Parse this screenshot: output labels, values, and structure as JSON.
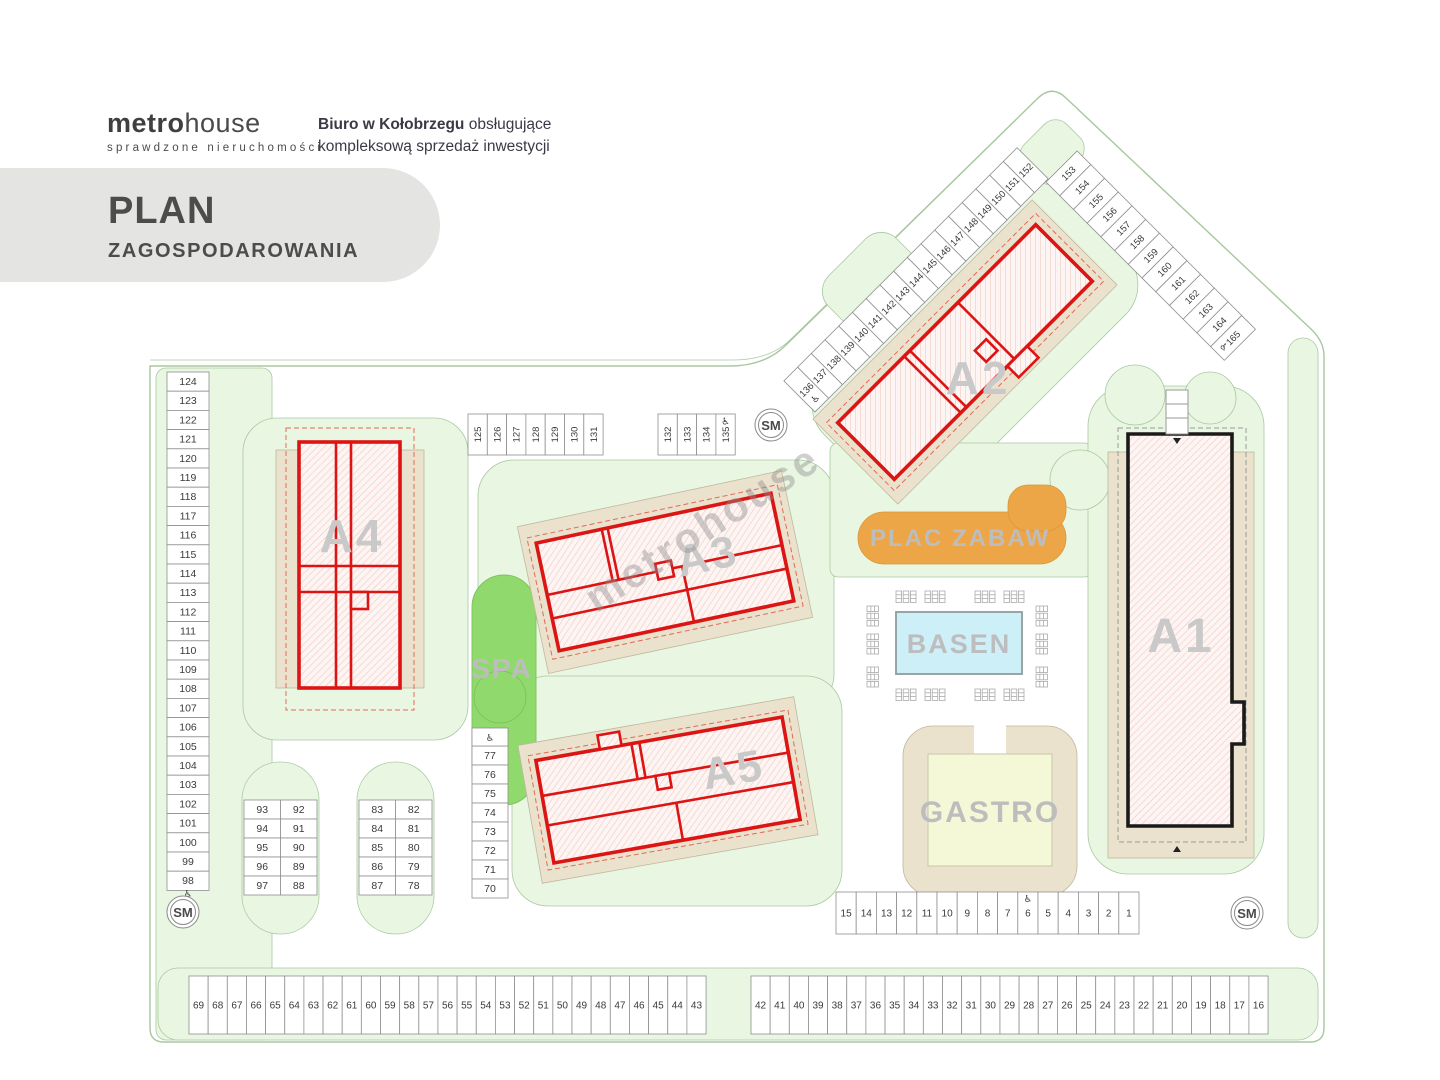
{
  "header": {
    "logo_primary": "metro",
    "logo_secondary": "house",
    "logo_tagline": "sprawdzone nieruchomości",
    "office_line1_bold": "Biuro w Kołobrzegu",
    "office_line1_rest": " obsługujące",
    "office_line2": "kompleksową sprzedaż inwestycji",
    "title_line1": "PLAN",
    "title_line2": "ZAGOSPODAROWANIA"
  },
  "watermark": "metrohouse",
  "icons": {
    "disabled": "♿"
  },
  "map": {
    "buildings": {
      "a1": "A1",
      "a2": "A2",
      "a3": "A3",
      "a4": "A4",
      "a5": "A5"
    },
    "areas": {
      "spa": "SPA",
      "basen": "BASEN",
      "gastro": "GASTRO",
      "plac_zabaw": "PLAC ZABAW"
    },
    "sm_label": "SM",
    "colors": {
      "building_outline": "#dd1414",
      "a1_outline": "#1a1a1a",
      "greenery": "#e9f6e2",
      "spa_green": "#90da6d",
      "playground_orange": "#eca648",
      "pool_blue": "#cdeff8"
    }
  },
  "parking": {
    "left_column": {
      "numbers": [
        "124",
        "123",
        "122",
        "121",
        "120",
        "119",
        "118",
        "117",
        "116",
        "115",
        "114",
        "113",
        "112",
        "111",
        "110",
        "109",
        "108",
        "107",
        "106",
        "105",
        "104",
        "103",
        "102",
        "101",
        "100",
        "99",
        "98"
      ],
      "disabled": [
        "98"
      ]
    },
    "row_125_131": {
      "numbers": [
        "125",
        "126",
        "127",
        "128",
        "129",
        "130",
        "131"
      ],
      "disabled": []
    },
    "row_132_135": {
      "numbers": [
        "132",
        "133",
        "134",
        "135"
      ],
      "disabled": [
        "135"
      ]
    },
    "diag_136_152": {
      "numbers": [
        "136",
        "137",
        "138",
        "139",
        "140",
        "141",
        "142",
        "143",
        "144",
        "145",
        "146",
        "147",
        "148",
        "149",
        "150",
        "151",
        "152"
      ],
      "disabled": [
        "136"
      ]
    },
    "diag_153_165": {
      "numbers": [
        "153",
        "154",
        "155",
        "156",
        "157",
        "158",
        "159",
        "160",
        "161",
        "162",
        "163",
        "164",
        "165"
      ],
      "disabled": [
        "165"
      ]
    },
    "column_77_70": {
      "numbers": [
        "77",
        "76",
        "75",
        "74",
        "73",
        "72",
        "71",
        "70"
      ],
      "disabled": []
    },
    "mid_row_15_1": {
      "numbers": [
        "15",
        "14",
        "13",
        "12",
        "11",
        "10",
        "9",
        "8",
        "7",
        "6",
        "5",
        "4",
        "3",
        "2",
        "1"
      ],
      "disabled": [
        "6"
      ]
    },
    "bottom_row_69_43": {
      "numbers": [
        "69",
        "68",
        "67",
        "66",
        "65",
        "64",
        "63",
        "62",
        "61",
        "60",
        "59",
        "58",
        "57",
        "56",
        "55",
        "54",
        "53",
        "52",
        "51",
        "50",
        "49",
        "48",
        "47",
        "46",
        "45",
        "44",
        "43"
      ],
      "disabled": []
    },
    "bottom_row_42_16": {
      "numbers": [
        "42",
        "41",
        "40",
        "39",
        "38",
        "37",
        "36",
        "35",
        "34",
        "33",
        "32",
        "31",
        "30",
        "29",
        "28",
        "27",
        "26",
        "25",
        "24",
        "23",
        "22",
        "21",
        "20",
        "19",
        "18",
        "17",
        "16"
      ],
      "disabled": []
    },
    "island_93_88": {
      "rows": [
        [
          "93",
          "92"
        ],
        [
          "94",
          "91"
        ],
        [
          "95",
          "90"
        ],
        [
          "96",
          "89"
        ],
        [
          "97",
          "88"
        ]
      ]
    },
    "island_83_78": {
      "rows": [
        [
          "83",
          "82"
        ],
        [
          "84",
          "81"
        ],
        [
          "85",
          "80"
        ],
        [
          "86",
          "79"
        ],
        [
          "87",
          "78"
        ]
      ]
    }
  }
}
